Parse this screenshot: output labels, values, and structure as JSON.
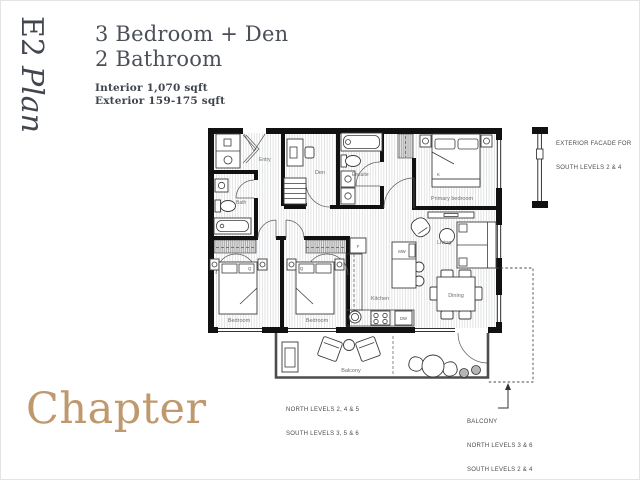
{
  "page": {
    "background": "#ffffff",
    "ink": "#4a4f58",
    "accent_gold": "#bf986d"
  },
  "sidebar": {
    "plan_code": "E2",
    "plan_word": "Plan"
  },
  "header": {
    "title_line1": "3 Bedroom + Den",
    "title_line2": "2 Bathroom",
    "interior_area": "Interior 1,070 sqft",
    "exterior_area": "Exterior 159-175 sqft"
  },
  "rooms": {
    "entry": "Entry",
    "den": "Den",
    "ensuite": "Ensuite",
    "bath": "Bath",
    "primary_bedroom": "Primary bedroom",
    "bedroom_a": "Bedroom",
    "bedroom_b": "Bedroom",
    "kitchen": "Kitchen",
    "living": "Living",
    "dining": "Dining",
    "balcony": "Balcony"
  },
  "fixtures": {
    "fridge": "F",
    "microwave": "MW",
    "dishwasher": "DW",
    "king_bed": "K",
    "queen_bed_a": "Q",
    "queen_bed_b": "Q"
  },
  "annotations": {
    "facade_line1": "EXTERIOR FACADE FOR",
    "facade_line2": "SOUTH LEVELS 2 & 4",
    "balcony_levels_line1": "NORTH LEVELS 2, 4 & 5",
    "balcony_levels_line2": "SOUTH LEVELS 3, 5 & 6",
    "balcony_callout_title": "BALCONY",
    "balcony_callout_line1": "NORTH LEVELS 3 & 6",
    "balcony_callout_line2": "SOUTH LEVELS 2 & 4"
  },
  "brand": {
    "logo": "Chapter"
  }
}
